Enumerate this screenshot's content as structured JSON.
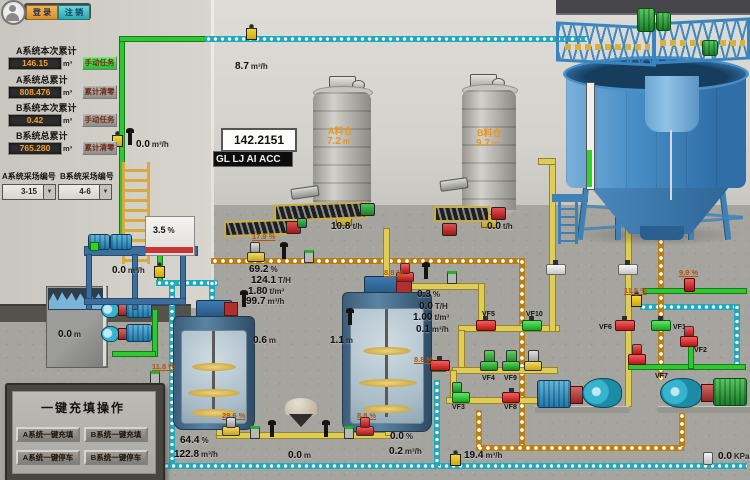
{
  "colors": {
    "pipe_green": "#2fc832",
    "pipe_yellow": "#e0cd55",
    "pipe_cyan": "#1fa9bd",
    "pipe_orange": "#b97f10",
    "valve_red": "#d42222",
    "valve_green": "#1fcc2a",
    "value_orange": "#f0a030",
    "btn_login": "#e8a23c",
    "btn_logout": "#45c4c4",
    "btn_action_green": "#35d93a"
  },
  "login": {
    "login_label": "登 录",
    "logout_label": "注 销"
  },
  "totals": {
    "groups": [
      {
        "label": "A系统本次累计",
        "value": "146.15",
        "unit": "m³",
        "action": "手动任务"
      },
      {
        "label": "A系统总累计",
        "value": "808.476",
        "unit": "m³",
        "action": "累计清零"
      },
      {
        "label": "B系统本次累计",
        "value": "0.42",
        "unit": "m³",
        "action": "手动任务"
      },
      {
        "label": "B系统总累计",
        "value": "765.280",
        "unit": "m³",
        "action": "累计清零"
      }
    ]
  },
  "sites": {
    "a_label": "A系统采场编号",
    "b_label": "B系统采场编号",
    "a_value": "3-15",
    "b_value": "4-6",
    "arrow": "▼"
  },
  "display": {
    "value": "142.2151",
    "marquee": "GL LJ AI ACC"
  },
  "silos": {
    "a_name": "A料仓",
    "a_level": "7.2",
    "a_unit": "m",
    "b_name": "B料仓",
    "b_level": "9.7",
    "b_unit": "m"
  },
  "readouts": [
    {
      "v": "0.0",
      "u": "m³/h"
    },
    {
      "v": "8.7",
      "u": "m³/h"
    },
    {
      "v": "0.0",
      "u": "m³/h"
    },
    {
      "v": "10.8",
      "u": "t/h"
    },
    {
      "v": "0.0",
      "u": "t/h"
    },
    {
      "v": "17.9",
      "u": "%"
    },
    {
      "v": "69.2",
      "u": "%"
    },
    {
      "v": "124.1",
      "u": "T/H"
    },
    {
      "v": "1.80",
      "u": "t/m³"
    },
    {
      "v": "99.7",
      "u": "m³/h"
    },
    {
      "v": "8.8",
      "u": "%"
    },
    {
      "v": "0.3",
      "u": "%"
    },
    {
      "v": "0.0",
      "u": "T/H"
    },
    {
      "v": "1.00",
      "u": "t/m³"
    },
    {
      "v": "0.1",
      "u": "m³/h"
    },
    {
      "v": "0.6",
      "u": "m"
    },
    {
      "v": "1.1",
      "u": "m"
    },
    {
      "v": "11.8",
      "u": "%"
    },
    {
      "v": "8.8",
      "u": "%"
    },
    {
      "v": "0.0",
      "u": "m"
    },
    {
      "v": "28.6",
      "u": "%"
    },
    {
      "v": "8.8",
      "u": "%"
    },
    {
      "v": "64.4",
      "u": "%"
    },
    {
      "v": "122.8",
      "u": "m³/h"
    },
    {
      "v": "0.0",
      "u": "m"
    },
    {
      "v": "0.0",
      "u": "%"
    },
    {
      "v": "0.2",
      "u": "m³/h"
    },
    {
      "v": "19.4",
      "u": "m³/h"
    },
    {
      "v": "11.5",
      "u": "%"
    },
    {
      "v": "9.9",
      "u": "%"
    },
    {
      "v": "0.0",
      "u": "KPa"
    },
    {
      "v": "3.5",
      "u": "%"
    }
  ],
  "valves": [
    {
      "id": "VF1"
    },
    {
      "id": "VF2"
    },
    {
      "id": "VF3"
    },
    {
      "id": "VF4"
    },
    {
      "id": "VF5"
    },
    {
      "id": "VF6"
    },
    {
      "id": "VF7"
    },
    {
      "id": "VF8"
    },
    {
      "id": "VF9"
    },
    {
      "id": "VF10"
    }
  ],
  "quick_panel": {
    "title": "一键充填操作",
    "buttons": [
      "A系统一键充填",
      "B系统一键充填",
      "A系统一键停车",
      "B系统一键停车"
    ]
  },
  "icons": {
    "avatar": "user-avatar",
    "flow_sensor": "wireless-flow-sensor",
    "level_sensor": "level-transmitter",
    "density_sensor": "density-sensor",
    "pressure_sensor": "pressure-sensor",
    "dropdown_arrow": "▼"
  }
}
